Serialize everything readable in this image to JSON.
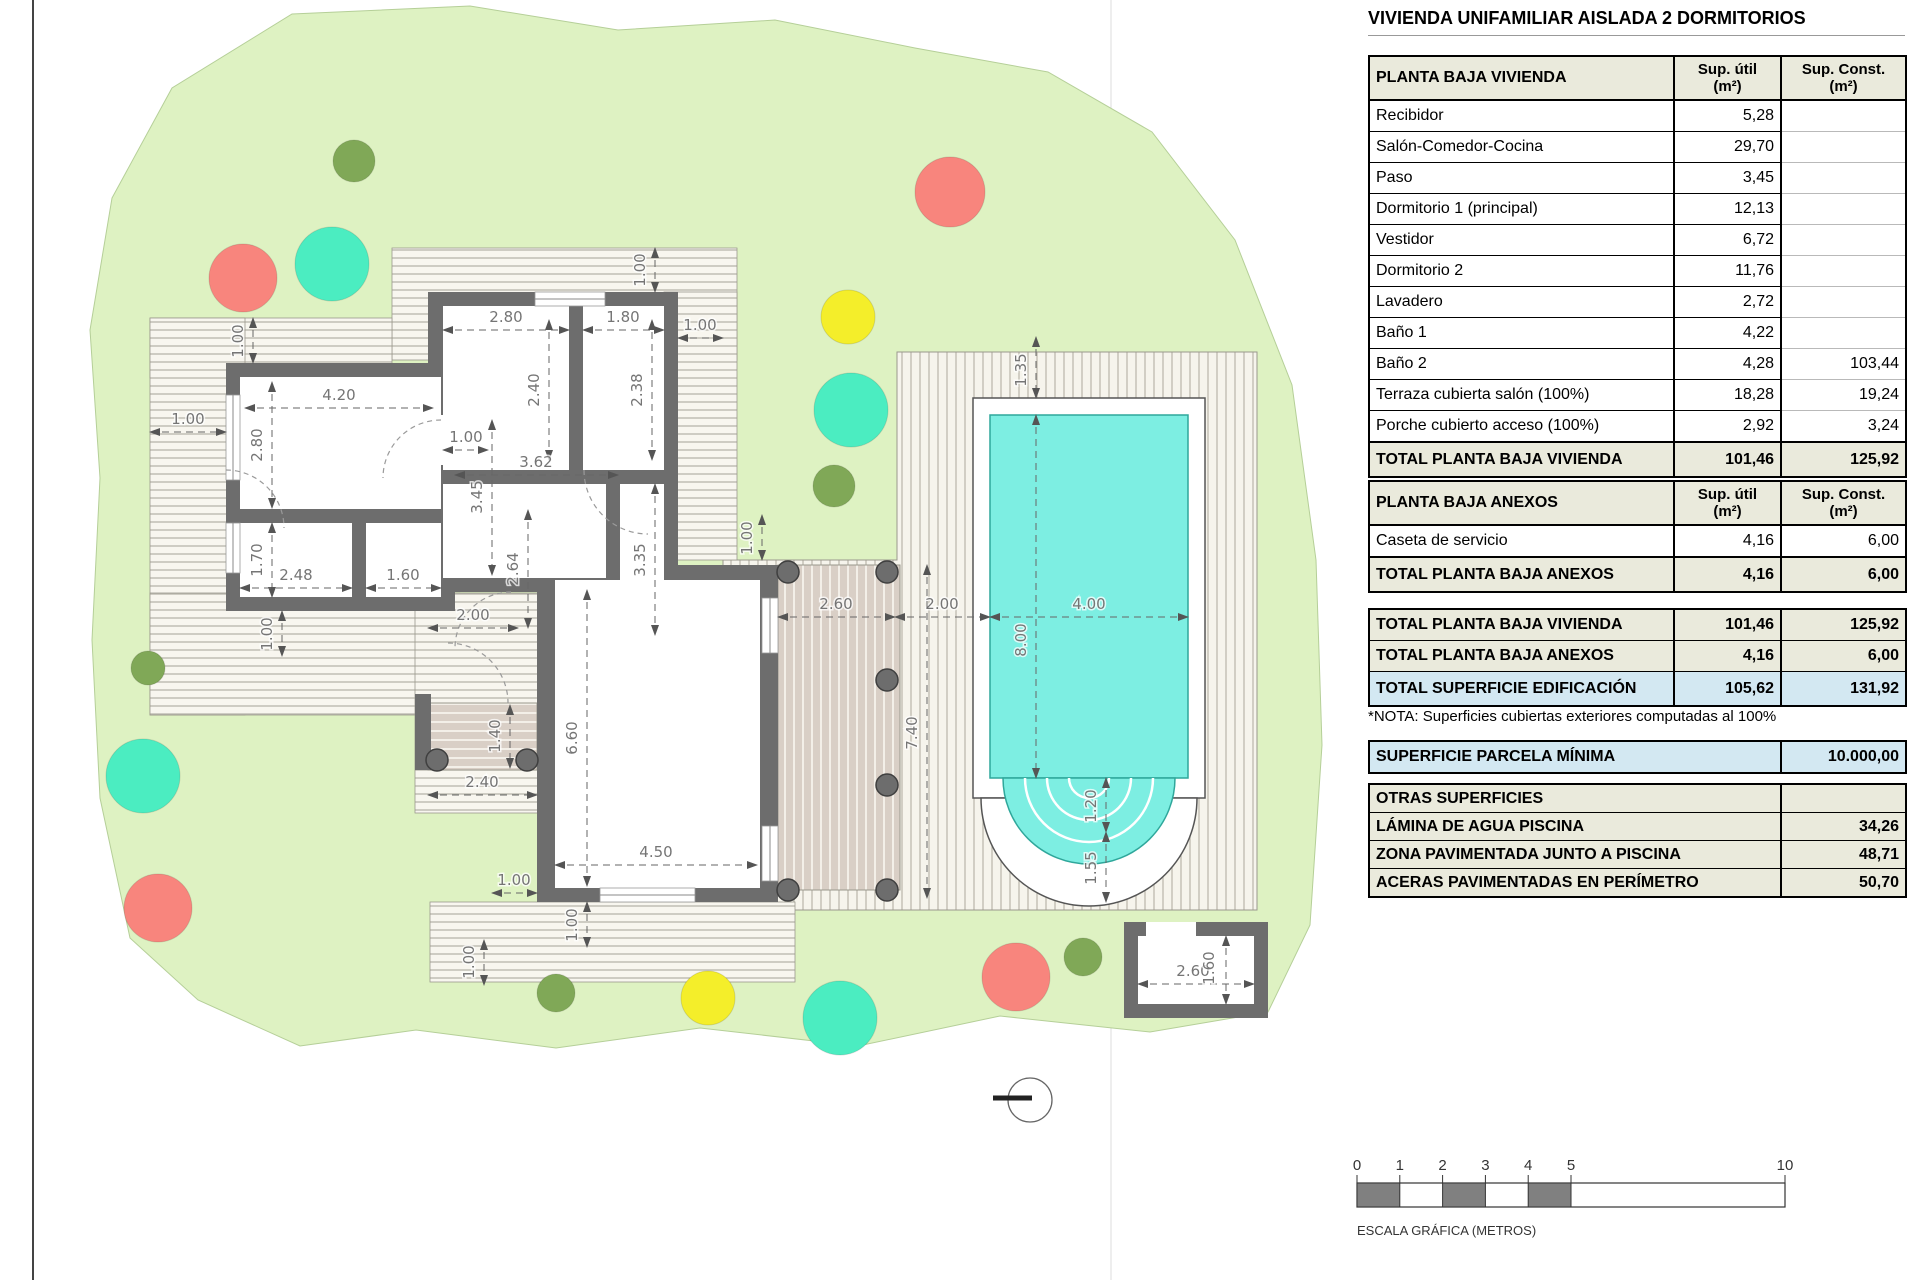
{
  "title": "VIVIENDA UNIFAMILIAR AISLADA 2 DORMITORIOS",
  "cols": {
    "util": "Sup. útil\n(m²)",
    "const": "Sup. Const.\n(m²)"
  },
  "tables": {
    "vivienda": {
      "header": "PLANTA BAJA VIVIENDA",
      "rows": [
        [
          "Recibidor",
          "5,28",
          ""
        ],
        [
          "Salón-Comedor-Cocina",
          "29,70",
          ""
        ],
        [
          "Paso",
          "3,45",
          ""
        ],
        [
          "Dormitorio 1 (principal)",
          "12,13",
          ""
        ],
        [
          "Vestidor",
          "6,72",
          ""
        ],
        [
          "Dormitorio 2",
          "11,76",
          ""
        ],
        [
          "Lavadero",
          "2,72",
          ""
        ],
        [
          "Baño 1",
          "4,22",
          ""
        ],
        [
          "Baño 2",
          "4,28",
          "103,44"
        ],
        [
          "Terraza cubierta salón (100%)",
          "18,28",
          "19,24"
        ],
        [
          "Porche cubierto acceso (100%)",
          "2,92",
          "3,24"
        ]
      ],
      "total": [
        "TOTAL PLANTA BAJA VIVIENDA",
        "101,46",
        "125,92"
      ]
    },
    "anexos": {
      "header": "PLANTA BAJA ANEXOS",
      "rows": [
        [
          "Caseta de servicio",
          "4,16",
          "6,00"
        ]
      ],
      "total": [
        "TOTAL PLANTA BAJA ANEXOS",
        "4,16",
        "6,00"
      ]
    },
    "resumen": {
      "rows": [
        [
          "TOTAL PLANTA BAJA VIVIENDA",
          "101,46",
          "125,92",
          "beige"
        ],
        [
          "TOTAL PLANTA BAJA ANEXOS",
          "4,16",
          "6,00",
          "beige"
        ],
        [
          "TOTAL SUPERFICIE EDIFICACIÓN",
          "105,62",
          "131,92",
          "blue"
        ]
      ]
    },
    "nota": "*NOTA: Superficies cubiertas exteriores computadas al 100%",
    "parcela": {
      "label": "SUPERFICIE PARCELA MÍNIMA",
      "value": "10.000,00"
    },
    "otras": {
      "rows": [
        [
          "OTRAS SUPERFICIES",
          ""
        ],
        [
          "LÁMINA DE AGUA PISCINA",
          "34,26"
        ],
        [
          "ZONA PAVIMENTADA JUNTO A PISCINA",
          "48,71"
        ],
        [
          "ACERAS PAVIMENTADAS EN PERÍMETRO",
          "50,70"
        ]
      ]
    }
  },
  "scalebar": {
    "label": "ESCALA GRÁFICA (METROS)",
    "x0": 1357,
    "y": 1183,
    "h": 24,
    "px_per_m": 42.8,
    "ticks": [
      {
        "l": "0",
        "m": 0
      },
      {
        "l": "1",
        "m": 1
      },
      {
        "l": "2",
        "m": 2
      },
      {
        "l": "3",
        "m": 3
      },
      {
        "l": "4",
        "m": 4
      },
      {
        "l": "5",
        "m": 5
      },
      {
        "l": "10",
        "m": 10
      }
    ],
    "fill": [
      [
        0,
        1
      ],
      [
        2,
        3
      ],
      [
        4,
        5
      ]
    ]
  },
  "plan": {
    "colors": {
      "mint": "#4bedc1",
      "red": "#f8857d",
      "yellow": "#f4ee2a",
      "olive": "#80a857",
      "parcel": "#def2c2",
      "pool": "#7deee2"
    },
    "trees": [
      {
        "x": 354,
        "y": 161,
        "r": 21,
        "c": "olive"
      },
      {
        "x": 950,
        "y": 192,
        "r": 35,
        "c": "red"
      },
      {
        "x": 243,
        "y": 278,
        "r": 34,
        "c": "red"
      },
      {
        "x": 332,
        "y": 264,
        "r": 37,
        "c": "mint"
      },
      {
        "x": 848,
        "y": 317,
        "r": 27,
        "c": "yellow"
      },
      {
        "x": 851,
        "y": 410,
        "r": 37,
        "c": "mint"
      },
      {
        "x": 834,
        "y": 486,
        "r": 21,
        "c": "olive"
      },
      {
        "x": 148,
        "y": 668,
        "r": 17,
        "c": "olive"
      },
      {
        "x": 143,
        "y": 776,
        "r": 37,
        "c": "mint"
      },
      {
        "x": 158,
        "y": 908,
        "r": 34,
        "c": "red"
      },
      {
        "x": 556,
        "y": 993,
        "r": 19,
        "c": "olive"
      },
      {
        "x": 708,
        "y": 998,
        "r": 27,
        "c": "yellow"
      },
      {
        "x": 840,
        "y": 1018,
        "r": 37,
        "c": "mint"
      },
      {
        "x": 1016,
        "y": 977,
        "r": 34,
        "c": "red"
      },
      {
        "x": 1083,
        "y": 957,
        "r": 19,
        "c": "olive"
      }
    ],
    "dimensions": [
      {
        "t": "1.00",
        "x": 243,
        "y": 341,
        "r": 1,
        "line": [
          253,
          318,
          253,
          363
        ]
      },
      {
        "t": "1.00",
        "x": 188,
        "y": 424,
        "r": 0,
        "line": [
          150,
          432,
          226,
          432
        ]
      },
      {
        "t": "4.20",
        "x": 339,
        "y": 400,
        "r": 0,
        "line": [
          245,
          408,
          433,
          408
        ]
      },
      {
        "t": "2.80",
        "x": 262,
        "y": 445,
        "r": 1,
        "line": [
          272,
          382,
          272,
          508
        ]
      },
      {
        "t": "2.80",
        "x": 506,
        "y": 322,
        "r": 0,
        "line": [
          443,
          330,
          569,
          330
        ]
      },
      {
        "t": "1.80",
        "x": 623,
        "y": 322,
        "r": 0,
        "line": [
          583,
          330,
          664,
          330
        ]
      },
      {
        "t": "1.00",
        "x": 700,
        "y": 330,
        "r": 0,
        "line": [
          678,
          338,
          723,
          338
        ]
      },
      {
        "t": "1.00",
        "x": 645,
        "y": 270,
        "r": 1,
        "line": [
          655,
          248,
          655,
          292
        ]
      },
      {
        "t": "2.40",
        "x": 539,
        "y": 390,
        "r": 1,
        "line": [
          549,
          320,
          549,
          460
        ]
      },
      {
        "t": "2.38",
        "x": 642,
        "y": 390,
        "r": 1,
        "line": [
          652,
          320,
          652,
          460
        ]
      },
      {
        "t": "1.00",
        "x": 466,
        "y": 442,
        "r": 0,
        "line": [
          443,
          450,
          488,
          450
        ]
      },
      {
        "t": "3.62",
        "x": 536,
        "y": 467,
        "r": 0,
        "line": [
          455,
          475,
          618,
          475
        ]
      },
      {
        "t": "3.45",
        "x": 482,
        "y": 497,
        "r": 1,
        "line": [
          492,
          420,
          492,
          575
        ]
      },
      {
        "t": "3.35",
        "x": 645,
        "y": 560,
        "r": 1,
        "line": [
          655,
          484,
          655,
          635
        ]
      },
      {
        "t": "1.70",
        "x": 262,
        "y": 560,
        "r": 1,
        "line": [
          272,
          523,
          272,
          597
        ]
      },
      {
        "t": "2.48",
        "x": 296,
        "y": 580,
        "r": 0,
        "line": [
          240,
          588,
          352,
          588
        ]
      },
      {
        "t": "1.60",
        "x": 403,
        "y": 580,
        "r": 0,
        "line": [
          366,
          588,
          441,
          588
        ]
      },
      {
        "t": "1.00",
        "x": 272,
        "y": 634,
        "r": 1,
        "line": [
          282,
          611,
          282,
          656
        ]
      },
      {
        "t": "2.00",
        "x": 473,
        "y": 620,
        "r": 0,
        "line": [
          428,
          628,
          518,
          628
        ]
      },
      {
        "t": "2.64",
        "x": 518,
        "y": 569,
        "r": 1,
        "line": [
          528,
          510,
          528,
          628
        ]
      },
      {
        "t": "1.40",
        "x": 500,
        "y": 736,
        "r": 1,
        "line": [
          510,
          705,
          510,
          768
        ]
      },
      {
        "t": "2.40",
        "x": 482,
        "y": 787,
        "r": 0,
        "line": [
          428,
          795,
          537,
          795
        ]
      },
      {
        "t": "6.60",
        "x": 577,
        "y": 738,
        "r": 1,
        "line": [
          587,
          590,
          587,
          886
        ]
      },
      {
        "t": "4.50",
        "x": 656,
        "y": 857,
        "r": 0,
        "line": [
          555,
          865,
          757,
          865
        ]
      },
      {
        "t": "1.00",
        "x": 514,
        "y": 885,
        "r": 0,
        "line": [
          492,
          893,
          537,
          893
        ]
      },
      {
        "t": "1.00",
        "x": 577,
        "y": 925,
        "r": 1,
        "line": [
          587,
          902,
          587,
          947
        ]
      },
      {
        "t": "1.00",
        "x": 474,
        "y": 962,
        "r": 1,
        "line": [
          484,
          940,
          484,
          985
        ]
      },
      {
        "t": "2.60",
        "x": 836,
        "y": 609,
        "r": 0,
        "line": [
          778,
          617,
          895,
          617
        ]
      },
      {
        "t": "2.00",
        "x": 942,
        "y": 609,
        "r": 0,
        "line": [
          895,
          617,
          990,
          617
        ]
      },
      {
        "t": "4.00",
        "x": 1089,
        "y": 609,
        "r": 0,
        "line": [
          990,
          617,
          1188,
          617
        ]
      },
      {
        "t": "8.00",
        "x": 1026,
        "y": 640,
        "r": 1,
        "line": [
          1036,
          415,
          1036,
          778
        ]
      },
      {
        "t": "1.35",
        "x": 1026,
        "y": 370,
        "r": 1,
        "line": [
          1036,
          337,
          1036,
          398
        ]
      },
      {
        "t": "7.40",
        "x": 917,
        "y": 733,
        "r": 1,
        "line": [
          927,
          565,
          927,
          898
        ]
      },
      {
        "t": "1.20",
        "x": 1096,
        "y": 806,
        "r": 1,
        "line": [
          1106,
          778,
          1106,
          832
        ]
      },
      {
        "t": "1.55",
        "x": 1096,
        "y": 868,
        "r": 1,
        "line": [
          1106,
          832,
          1106,
          902
        ]
      },
      {
        "t": "1.00",
        "x": 752,
        "y": 538,
        "r": 1,
        "line": [
          762,
          515,
          762,
          560
        ]
      },
      {
        "t": "2.60",
        "x": 1193,
        "y": 976,
        "r": 0,
        "line": [
          1138,
          984,
          1254,
          984
        ]
      },
      {
        "t": "1.60",
        "x": 1214,
        "y": 968,
        "r": 1,
        "line": [
          1226,
          936,
          1226,
          1004
        ]
      }
    ]
  }
}
